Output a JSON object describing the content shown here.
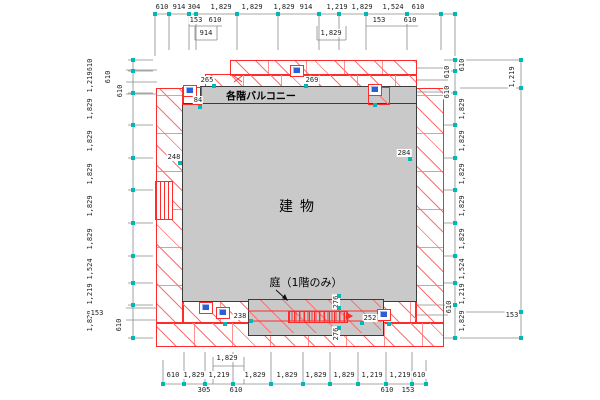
{
  "labels": {
    "building": "建物",
    "balcony": "各階バルコニー",
    "garden": "庭（1階のみ）"
  },
  "dimensions": {
    "top_row1": [
      "610",
      "914",
      "304",
      "1,829",
      "1,829",
      "1,829",
      "914",
      "1,219",
      "1,829",
      "1,524",
      "610"
    ],
    "top_row2": [
      "153",
      "610",
      "153",
      "610"
    ],
    "top_row3": [
      "914",
      "1,829"
    ],
    "bottom_row1": [
      "610",
      "1,829",
      "1,219",
      "1,829",
      "1,829",
      "1,829",
      "1,829",
      "1,219",
      "1,219",
      "610"
    ],
    "bottom_row2": [
      "305",
      "610",
      "610",
      "153"
    ],
    "bottom_row3": [
      "1,829"
    ],
    "left_col": [
      "610",
      "1,219",
      "1,829",
      "1,829",
      "1,829",
      "1,829",
      "1,829",
      "1,524",
      "1,219",
      "1,829"
    ],
    "left_subs": [
      "610",
      "610",
      "153",
      "610"
    ],
    "right_col": [
      "610",
      "1,829",
      "1,829",
      "1,829",
      "1,829",
      "1,829",
      "1,524",
      "1,219",
      "1,829"
    ],
    "right_outer": [
      "1,219",
      "153"
    ],
    "right_subs": [
      "610",
      "610",
      "610"
    ],
    "interior": [
      "265",
      "84",
      "269",
      "248",
      "284",
      "238",
      "252",
      "276",
      "276"
    ]
  },
  "colors": {
    "outline_red": "#ff2a2a",
    "hatch_red": "#ff7070",
    "fill_gray": "#c9c9c9",
    "edge_dark": "#3c3c3c",
    "dim_line_gray": "#8a8a8a",
    "tick_cyan": "#00b8b8",
    "symbol_blue": "#2b5fd4"
  }
}
